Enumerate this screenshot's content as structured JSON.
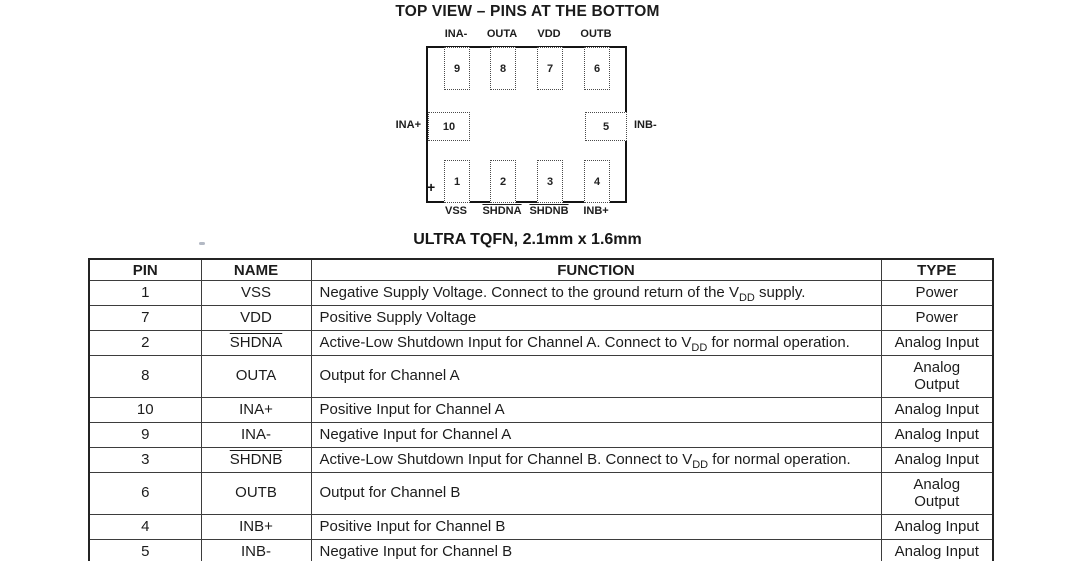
{
  "diagram": {
    "title": "TOP VIEW – PINS AT THE BOTTOM",
    "caption": "ULTRA TQFN, 2.1mm x 1.6mm",
    "polarity_mark": "+",
    "pins_top": [
      {
        "num": "9",
        "label": "INA-"
      },
      {
        "num": "8",
        "label": "OUTA"
      },
      {
        "num": "7",
        "label": "VDD"
      },
      {
        "num": "6",
        "label": "OUTB"
      }
    ],
    "pins_bottom": [
      {
        "num": "1",
        "label": "VSS"
      },
      {
        "num": "2",
        "label": "SHDNA",
        "overline": true
      },
      {
        "num": "3",
        "label": "SHDNB",
        "overline": true
      },
      {
        "num": "4",
        "label": "INB+"
      }
    ],
    "pin_left": {
      "num": "10",
      "label": "INA+"
    },
    "pin_right": {
      "num": "5",
      "label": "INB-"
    }
  },
  "table": {
    "headers": [
      "PIN",
      "NAME",
      "FUNCTION",
      "TYPE"
    ],
    "rows": [
      {
        "pin": "1",
        "name": "VSS",
        "function": [
          {
            "text": "Negative Supply Voltage. Connect to the ground return of the V"
          },
          {
            "sub": "DD"
          },
          {
            "text": " supply."
          }
        ],
        "type_lines": [
          "Power"
        ]
      },
      {
        "pin": "7",
        "name": "VDD",
        "function": [
          {
            "text": "Positive Supply Voltage"
          }
        ],
        "type_lines": [
          "Power"
        ]
      },
      {
        "pin": "2",
        "name": "SHDNA",
        "overline": true,
        "function": [
          {
            "text": "Active-Low Shutdown Input for Channel A. Connect to V"
          },
          {
            "sub": "DD"
          },
          {
            "text": " for normal operation."
          }
        ],
        "type_lines": [
          "Analog Input"
        ]
      },
      {
        "pin": "8",
        "name": "OUTA",
        "function": [
          {
            "text": "Output for Channel A"
          }
        ],
        "type_lines": [
          "Analog",
          "Output"
        ]
      },
      {
        "pin": "10",
        "name": "INA+",
        "function": [
          {
            "text": "Positive Input for Channel A"
          }
        ],
        "type_lines": [
          "Analog Input"
        ]
      },
      {
        "pin": "9",
        "name": "INA-",
        "function": [
          {
            "text": "Negative Input for Channel A"
          }
        ],
        "type_lines": [
          "Analog Input"
        ]
      },
      {
        "pin": "3",
        "name": "SHDNB",
        "overline": true,
        "function": [
          {
            "text": "Active-Low Shutdown Input for Channel B. Connect to V"
          },
          {
            "sub": "DD"
          },
          {
            "text": " for normal operation."
          }
        ],
        "type_lines": [
          "Analog Input"
        ]
      },
      {
        "pin": "6",
        "name": "OUTB",
        "function": [
          {
            "text": "Output for Channel B"
          }
        ],
        "type_lines": [
          "Analog",
          "Output"
        ]
      },
      {
        "pin": "4",
        "name": "INB+",
        "function": [
          {
            "text": "Positive Input for Channel B"
          }
        ],
        "type_lines": [
          "Analog Input"
        ]
      },
      {
        "pin": "5",
        "name": "INB-",
        "function": [
          {
            "text": "Negative Input for Channel B"
          }
        ],
        "type_lines": [
          "Analog Input"
        ]
      }
    ]
  },
  "colors": {
    "text": "#1c1c1c",
    "table_border": "#3d3d3d",
    "package_border": "#141414",
    "background": "#ffffff"
  }
}
